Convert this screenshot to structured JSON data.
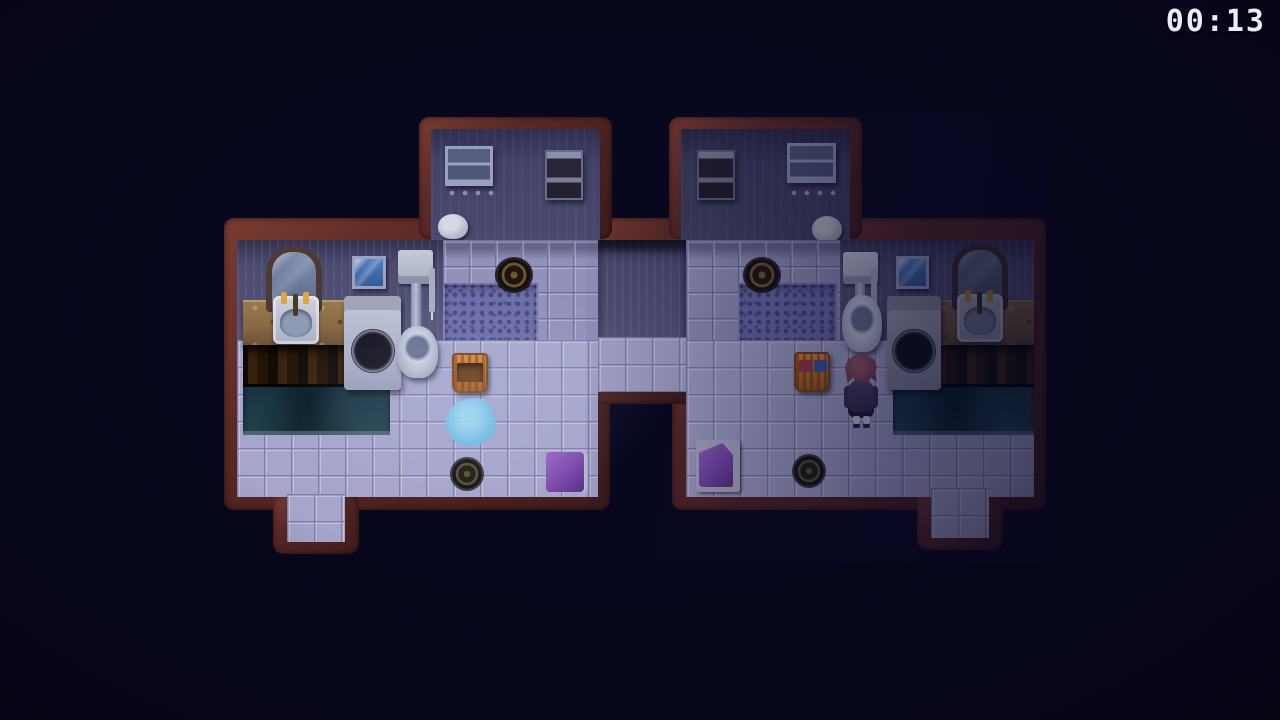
{
  "hud": {
    "timer": "00:13"
  },
  "colors": {
    "background": "#07071d",
    "wall_border": "#5a2824",
    "floor_tile_left": "#a6a6cc",
    "floor_tile_right_shade": "#8c8cb8",
    "wall_tile": "#9191bb",
    "mosaic": "#6c6ca8",
    "counter_granite": "#8a6a44",
    "bath_water": "#1d3a48",
    "basket_orange": "#c07428",
    "puddle_blue": "#66bce4",
    "mat_purple": "#7a48aa",
    "character_hair": "#7c4050",
    "timer_text": "#e9edf5"
  },
  "scene": {
    "label": "twin-bathhouse-map",
    "rooms": [
      "left-changing-room",
      "right-changing-room",
      "left-bathroom",
      "right-bathroom",
      "center-corridor"
    ],
    "objects": [
      "towel-shelf",
      "supply-cabinet",
      "coat-hooks",
      "laundry-bag",
      "arch-mirror",
      "vanity-sink",
      "granite-counter",
      "wooden-lockers",
      "sunken-bath",
      "washing-machine",
      "wall-mirror",
      "toilet",
      "wall-drain-grate",
      "floor-drain",
      "wicker-basket",
      "towel-basket",
      "water-puddle",
      "purple-bath-mat",
      "purple-towel-rack",
      "player-character",
      "south-exit-left",
      "south-exit-right"
    ]
  }
}
